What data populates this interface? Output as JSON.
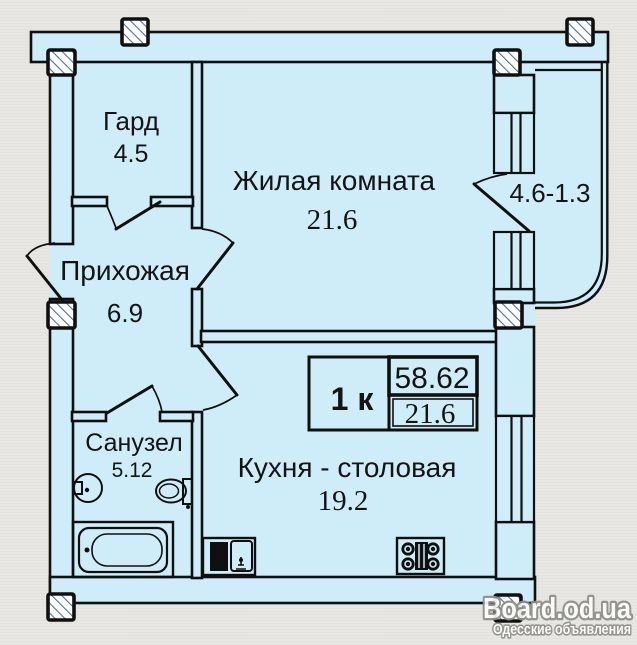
{
  "colors": {
    "plan_fill": "#cfecf9",
    "wall_line": "#101010",
    "background": "#e7e6e2",
    "hatch_line": "#4f7396",
    "watermark_fill": "#fcfcfa",
    "watermark_outline": "#8d8d89"
  },
  "rooms": {
    "wardrobe": {
      "label": "Гард",
      "area": "4.5"
    },
    "living_room": {
      "label": "Жилая комната",
      "area": "21.6"
    },
    "hallway": {
      "label": "Прихожая",
      "area": "6.9"
    },
    "bathroom": {
      "label": "Санузел",
      "area": "5.12"
    },
    "kitchen_dining": {
      "label": "Кухня - столовая",
      "area": "19.2"
    },
    "balcony": {
      "dimensions": "4.6-1.3"
    }
  },
  "info_box": {
    "type_label": "1 к",
    "total_area": "58.62",
    "living_area": "21.6"
  },
  "watermark": {
    "site": "Board.od.ua",
    "tagline": "Одесские объявления"
  },
  "fixtures": [
    "bathtub",
    "toilet",
    "sink",
    "kitchen-sink",
    "stove",
    "column"
  ]
}
